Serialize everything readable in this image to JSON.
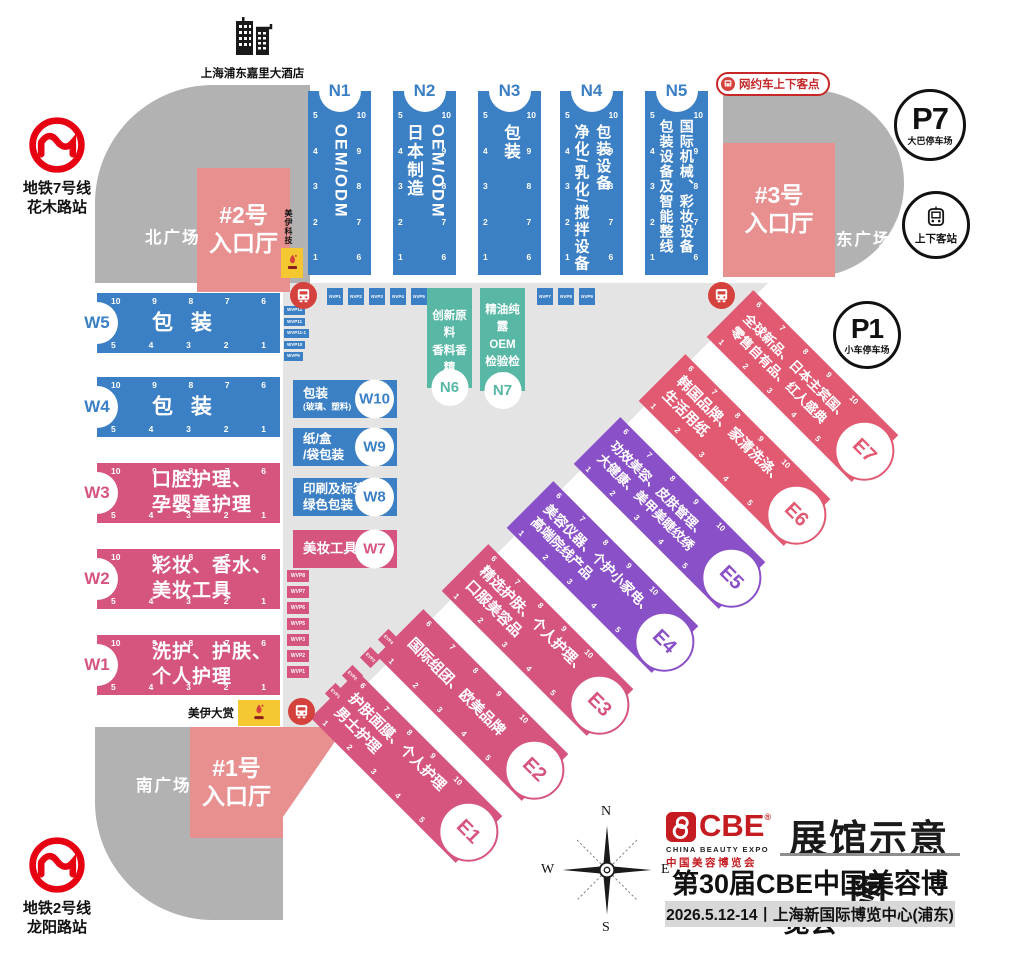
{
  "title_block": {
    "logo_mark": "CBE",
    "logo_reg": "®",
    "logo_sub_en": "CHINA BEAUTY EXPO",
    "logo_sub_cn": "中国美容博览会",
    "map_title": "展馆示意图",
    "expo_title": "第30届CBE中国美容博览会",
    "date_venue": "2026.5.12-14丨上海新国际博览中心(浦东)"
  },
  "landmarks": {
    "hotel": "上海浦东嘉里大酒店",
    "metro_line7": "地铁7号线\n花木路站",
    "metro_line2": "地铁2号线\n龙阳路站",
    "ride_hailing": "网约车上下客点",
    "p7_code": "P7",
    "p7_label": "大巴停车场",
    "p1_code": "P1",
    "p1_label": "小车停车场",
    "pickup_station": "上下客站",
    "north_plaza": "北广场",
    "east_plaza": "东广场",
    "south_plaza": "南广场",
    "sponsor_north": "美伊科技",
    "sponsor_south": "美伊大赏"
  },
  "entrances": {
    "no2": "#2号\n入口厅",
    "no3": "#3号\n入口厅",
    "no1": "#1号\n入口厅"
  },
  "halls": {
    "north": [
      {
        "id": "N1",
        "text": "OEM/ODM"
      },
      {
        "id": "N2",
        "text": "OEM/ODM\n日本制造"
      },
      {
        "id": "N3",
        "text": "包装"
      },
      {
        "id": "N4",
        "text": "包装设备\n净化/乳化/搅拌设备"
      },
      {
        "id": "N5",
        "text": "国际机械、彩妆设备\n包装设备及智能整线"
      }
    ],
    "north_annex": [
      {
        "id": "N6",
        "text": "创新原料\n香料香精"
      },
      {
        "id": "N7",
        "text": "精油纯露\nOEM\n检验检测"
      }
    ],
    "west": [
      {
        "id": "W5",
        "text": "包 装"
      },
      {
        "id": "W4",
        "text": "包 装"
      },
      {
        "id": "W3",
        "text": "口腔护理、\n孕婴童护理"
      },
      {
        "id": "W2",
        "text": "彩妆、香水、\n美妆工具"
      },
      {
        "id": "W1",
        "text": "洗护、护肤、\n个人护理"
      }
    ],
    "west_annex": [
      {
        "id": "W10",
        "text": "包装",
        "sub": "(玻璃、塑料)"
      },
      {
        "id": "W9",
        "text": "纸/盒\n/袋包装",
        "sub": ""
      },
      {
        "id": "W8",
        "text": "印刷及标签、\n绿色包装",
        "sub": ""
      },
      {
        "id": "W7",
        "text": "美妆工具",
        "sub": ""
      }
    ],
    "east": [
      {
        "id": "E1",
        "text": "护肤面膜、个人护理\n男士护理"
      },
      {
        "id": "E2",
        "text": "国际组团、欧美品牌"
      },
      {
        "id": "E3",
        "text": "精选护肤、个人护理、\n口服美容品"
      },
      {
        "id": "E4",
        "text": "美容仪器、个护小家电、\n高端院线产品"
      },
      {
        "id": "E5",
        "text": "功效美容、皮肤管理、\n大健康、美甲美睫纹绣"
      },
      {
        "id": "E6",
        "text": "韩国品牌、家清洗涤、\n生活用纸"
      },
      {
        "id": "E7",
        "text": "全球新品、日本主宾国、\n零售自有品、红人盛典"
      }
    ]
  },
  "gates": {
    "n_left": [
      "5",
      "4",
      "3",
      "2",
      "1"
    ],
    "n_right": [
      "10",
      "9",
      "8",
      "7",
      "6"
    ],
    "w_top": [
      "10",
      "9",
      "8",
      "7",
      "6"
    ],
    "w_bottom": [
      "5",
      "4",
      "3",
      "2",
      "1"
    ],
    "e_top": [
      "6",
      "7",
      "8",
      "9",
      "10"
    ],
    "e_bottom": [
      "1",
      "2",
      "3",
      "4",
      "5"
    ]
  },
  "tags": {
    "nvp_left": [
      "NVP1",
      "NVP2",
      "NVP3",
      "NVP4",
      "NVP5"
    ],
    "nvp_right": [
      "NVP7",
      "NVP8",
      "NVP9"
    ],
    "wvp_blue": [
      "WVP12",
      "WVP11",
      "WVP11-1",
      "WVP10",
      "WVP9"
    ],
    "wvp_pink": [
      "WVP8",
      "WVP7",
      "WVP6",
      "WVP5",
      "WVP3",
      "WVP2",
      "WVP1"
    ],
    "evp": [
      "EVP4",
      "EVP3",
      "EVP2",
      "EVP1"
    ]
  },
  "compass": {
    "n": "N",
    "e": "E",
    "s": "S",
    "w": "W"
  },
  "colors": {
    "blue": "#3b7fc4",
    "pink": "#d6557f",
    "rose": "#e15a72",
    "purple": "#8a50c8",
    "teal": "#58b7a5",
    "salmon": "#e89090",
    "plaza_gray": "#b2b2b2",
    "concourse_gray": "#e4e4e4",
    "metro_red": "#e60012",
    "brand_red": "#c41c20",
    "sponsor_yellow": "#f5c832"
  }
}
